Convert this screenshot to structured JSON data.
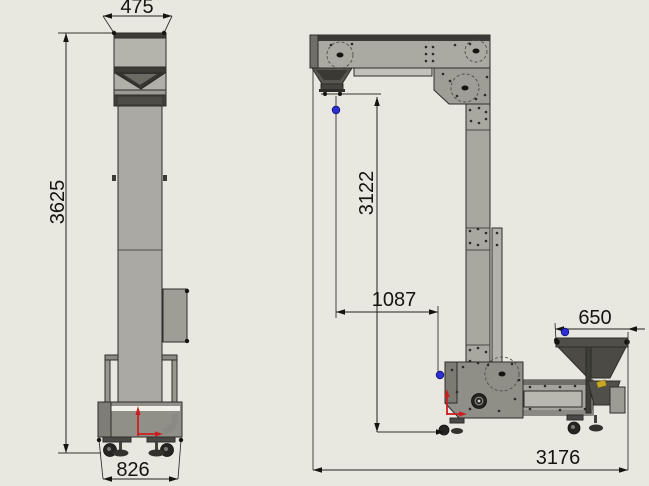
{
  "canvas": {
    "background": "#e9e8e0",
    "line_color": "#22211d",
    "accent_red": "#cc1f1f",
    "accent_blue": "#2e2ed6",
    "machine_gray": "#aba9a3",
    "dark_gray": "#3c3b36"
  },
  "front_view": {
    "dims": {
      "top_width": "475",
      "overall_height": "3625",
      "base_width": "826"
    }
  },
  "side_view": {
    "dims": {
      "drop_height": "3122",
      "horizontal_reach": "1087",
      "infeed_width": "650",
      "overall_length": "3176"
    }
  }
}
